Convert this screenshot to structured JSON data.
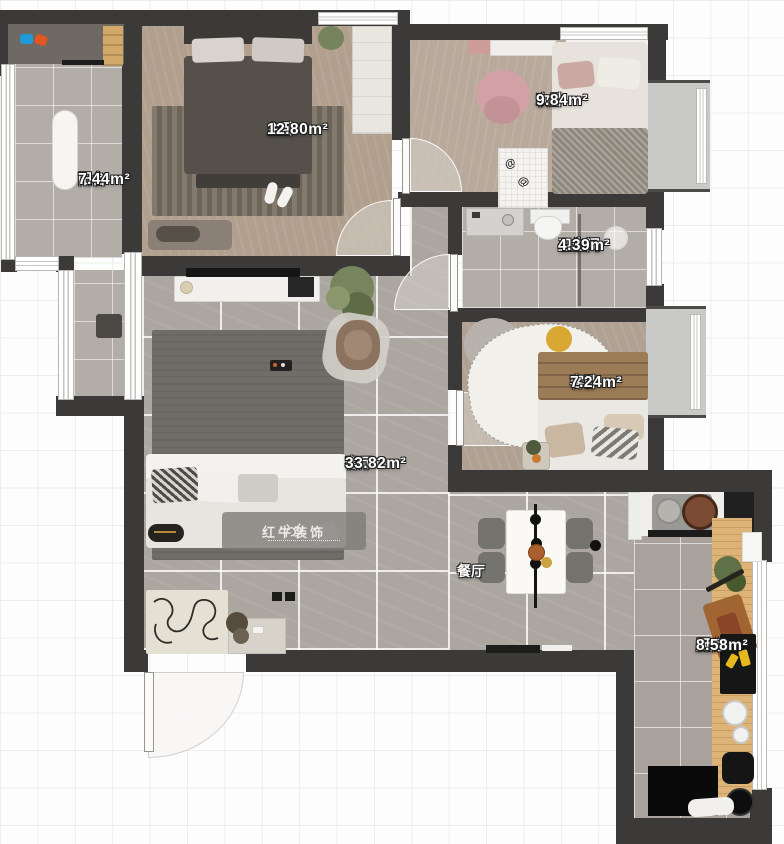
{
  "rooms": [
    {
      "id": "balcony",
      "name": "阳台",
      "area": "7.44m²"
    },
    {
      "id": "master-bedroom",
      "name": "主卧",
      "area": "12.80m²"
    },
    {
      "id": "second-bedroom",
      "name": "次卧",
      "area": "9.84m²"
    },
    {
      "id": "bathroom",
      "name": "卫生间",
      "area": "4.39m²"
    },
    {
      "id": "guest-bedroom",
      "name": "客卧",
      "area": "7.24m²"
    },
    {
      "id": "living-room",
      "name": "客厅",
      "area": "33.82m²"
    },
    {
      "id": "dining-room",
      "name": "餐厅",
      "area": ""
    },
    {
      "id": "kitchen",
      "name": "厨房",
      "area": "8.58m²"
    }
  ],
  "watermark": {
    "text": "红牛装饰"
  },
  "colors": {
    "wall": "#3b3a38",
    "tile": "#aca6a0",
    "carpet": "#b2a08f",
    "wood_counter": "#ddb377",
    "accent_yellow": "#d9a833",
    "accent_pink": "#d2a1a5",
    "watermark_bg": "#7c7a76"
  }
}
